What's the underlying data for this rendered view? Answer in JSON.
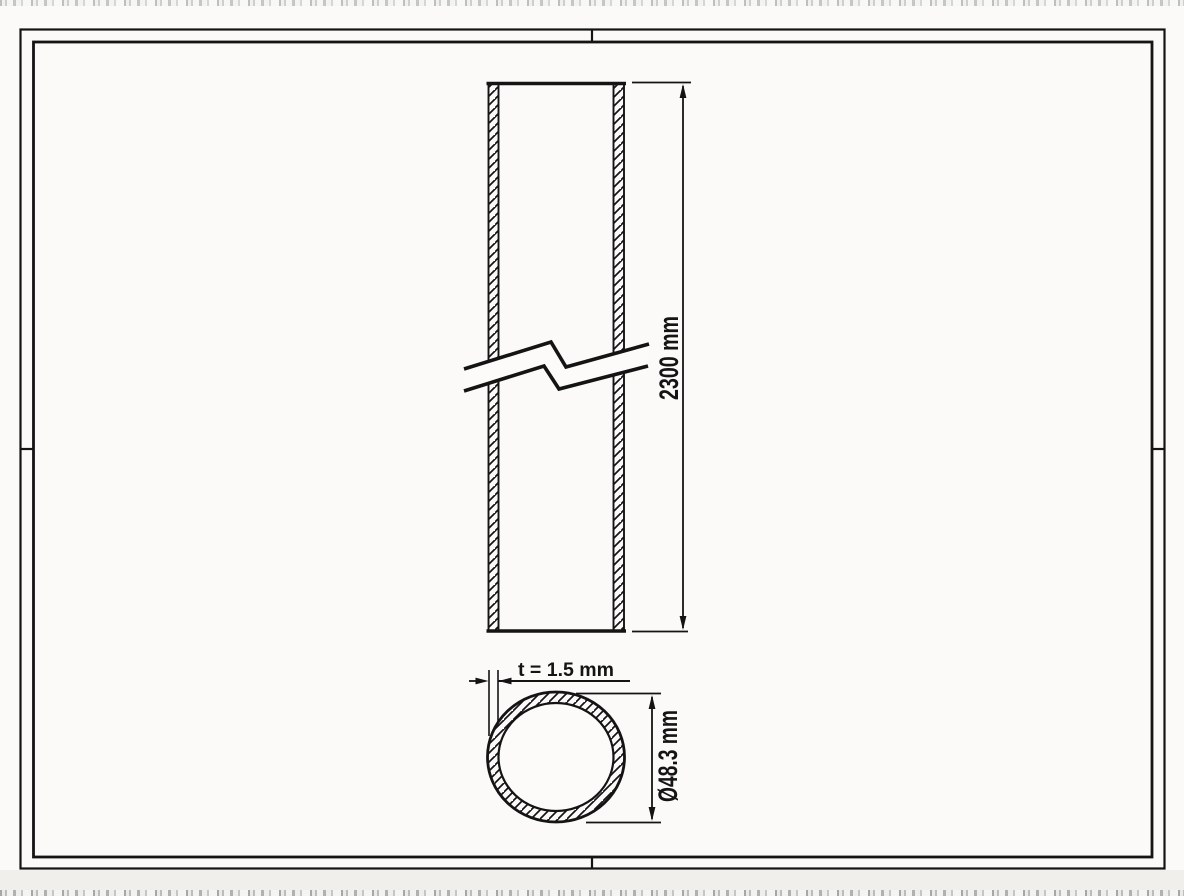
{
  "dimensions": {
    "length": {
      "label": "2300 mm",
      "value": 2300,
      "unit": "mm"
    },
    "wall_thickness": {
      "label": "t = 1.5 mm",
      "value": 1.5,
      "unit": "mm"
    },
    "outer_diameter": {
      "label": "Ø48.3 mm",
      "value": 48.3,
      "unit": "mm"
    }
  },
  "colors": {
    "ink": "#141414",
    "paper": "#fbfaf8",
    "margin_shade": "#f1efec"
  }
}
